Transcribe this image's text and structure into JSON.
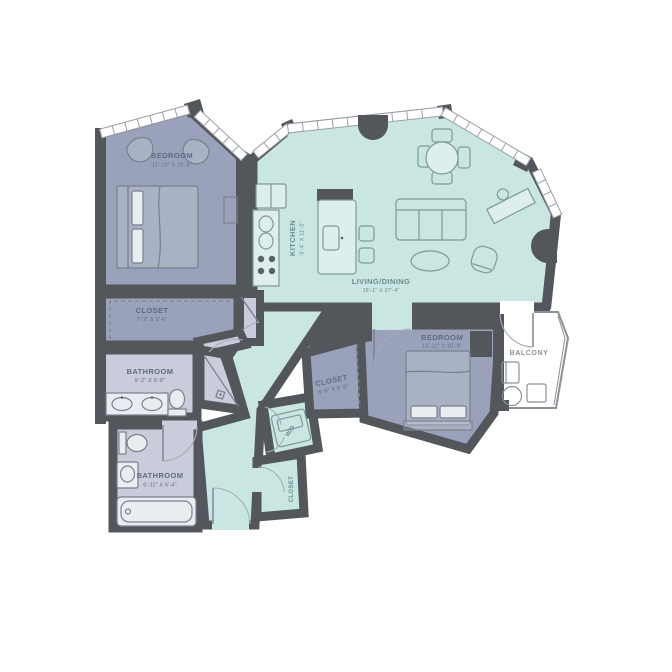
{
  "plan": {
    "colors": {
      "wall": "#53575b",
      "bedroom_fill": "#99a2ba",
      "bath_fill": "#c9ccdb",
      "living_fill": "#c9e6e3",
      "balcony_fill": "#ffffff"
    },
    "rooms": {
      "bedroom1": {
        "name": "BEDROOM",
        "dims": "11'-10\" X 15'-5\""
      },
      "closet1": {
        "name": "CLOSET",
        "dims": "7'-2\" X 5'-6\""
      },
      "bathroom1": {
        "name": "BATHROOM",
        "dims": "9'-2\" X 5'-8\""
      },
      "bathroom2": {
        "name": "BATHROOM",
        "dims": "6'-11\" X 6'-4\""
      },
      "kitchen": {
        "name": "KITCHEN",
        "dims": "9'-4\" X 11'-0\""
      },
      "living": {
        "name": "LIVING/DINING",
        "dims": "16'-1\" X 27'-4\""
      },
      "bedroom2": {
        "name": "BEDROOM",
        "dims": "10'-11\" X 10'-9\""
      },
      "closet2": {
        "name": "CLOSET",
        "dims": "6'-8\" X 5'-5\""
      },
      "closet3": {
        "name": "CLOSET"
      },
      "wd": {
        "name": "W/D"
      },
      "balcony": {
        "name": "BALCONY"
      }
    }
  }
}
